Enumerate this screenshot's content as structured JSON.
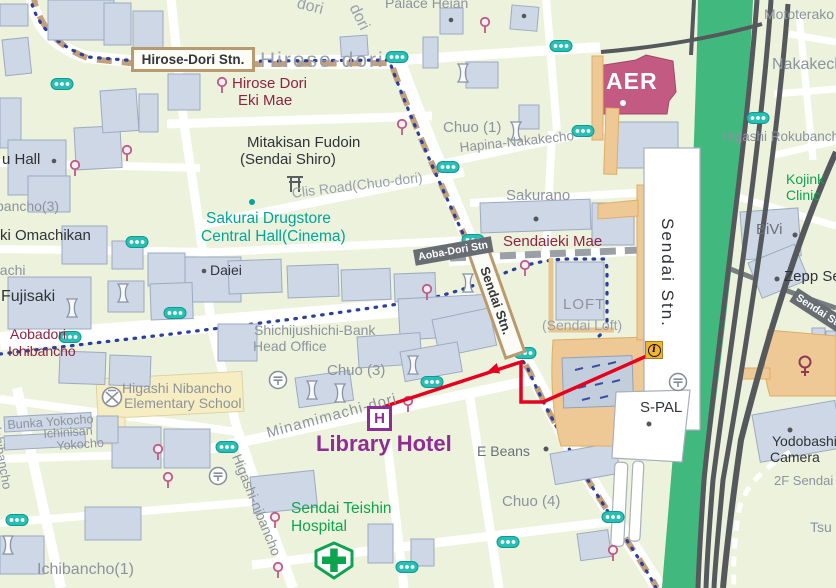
{
  "labels": {
    "hirose_station": "Hirose-Dori Stn.",
    "hirose_street": "Hirose-dori",
    "hirose_ekimae_1": "Hirose Dori",
    "hirose_ekimae_2": "Eki Mae",
    "palace_heian": "Palace Heian",
    "dori_a": "dori",
    "dori_b": "dori",
    "mototerakoji": "Mototerako",
    "nakakecho": "Nakakecho",
    "aer": "AER",
    "higashi_rokubancho": "Higashi Rokubancho",
    "kojinkai_1": "Kojink",
    "kojinkai_2": "Clinic",
    "bivi": "BiVi",
    "zepp": "Zepp Sendai",
    "senseki_sendai": "Sendai Stn.",
    "chuo_1": "Chuo (1)",
    "hapina": "Hapina-Nakakecho",
    "sakurano": "Sakurano",
    "sendaieki_mae": "Sendaieki Mae",
    "mitakisan_1": "Mitakisan Fudoin",
    "mitakisan_2": "(Sendai Shiro)",
    "clis_road": "Clis Road(Chuo-dori)",
    "sakurai_1": "Sakurai Drugstore",
    "sakurai_2": "Central Hall(Cinema)",
    "daiei": "Daiei",
    "u_hall": "u Hall",
    "bancho_3": "bancho(3)",
    "ki_omachikan": "ki Omachikan",
    "bachi": "bachi",
    "fujisaki": "Fujisaki",
    "aobadori_1": "Aobadori",
    "aobadori_2": "Ichibancho",
    "bank_1": "Shichijushichi-Bank",
    "bank_2": "Head Office",
    "school_1": "Higashi Nibancho",
    "school_2": "Elementary School",
    "chuo_3": "Chuo (3)",
    "minamimachi_dori": "Minamimachi-dori",
    "library_hotel": "Library Hotel",
    "e_beans": "E Beans",
    "chuo_4": "Chuo (4)",
    "teishin_1": "Sendai Teishin",
    "teishin_2": "Hospital",
    "higashi_nibancho_st": "Higashi-nibancho",
    "bunka_yokocho": "Bunka Yokocho",
    "ichinisan": "Ichinisan",
    "yokocho": "Yokocho",
    "ichibancho_v": "Ichibancho",
    "ichibancho_1": "Ichibancho(1)",
    "s_pal": "S-PAL",
    "yodobashi_1": "Yodobashi",
    "yodobashi_2": "Camera",
    "yodobashi_3": "2F Sendai",
    "tsu": "Tsu",
    "sendai_stn_building": "Sendai Stn.",
    "sendai_stn_road": "Sendai Stn.",
    "aoba_dori_stn": "Aoba-Dori Stn",
    "loft_1": "LOFT",
    "loft_2": "(Sendai Loft)"
  },
  "icons": {
    "info_letter": "i",
    "hotel_letter": "H"
  },
  "route": {
    "color": "#e60020",
    "points": [
      [
        658,
        351
      ],
      [
        543,
        402
      ],
      [
        521,
        402
      ],
      [
        521,
        362
      ],
      [
        383,
        407
      ]
    ]
  },
  "colors": {
    "route_red": "#e60020",
    "railway_green": "#41b97e",
    "track_gray": "#55585c",
    "building_fill": "#cdd7e5",
    "road_dash_tan": "#c3a07c",
    "subway_blue": "#2b3f9e",
    "signal_teal": "#2abfb4",
    "station_maroon": "#8e2342",
    "poi_teal": "#00a59b",
    "poi_green": "#0ea44e",
    "hotel_purple": "#8e2d93",
    "aer_pink": "#c25a82",
    "deck_tan": "#eec995"
  }
}
